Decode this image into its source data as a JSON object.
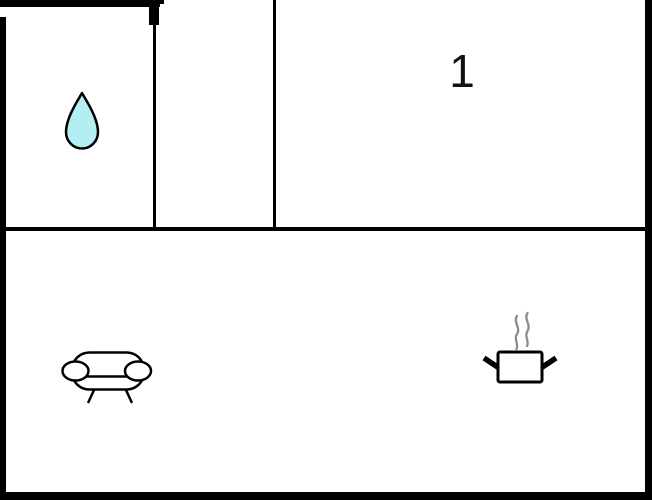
{
  "floorplan": {
    "room_label": "1",
    "icons": {
      "bathroom": "water-drop-icon",
      "living_room": "sofa-icon",
      "kitchen": "cooking-pot-steam-icon"
    },
    "colors": {
      "wall": "#000000",
      "background": "#ffffff",
      "water_drop_fill": "#b5eef2",
      "water_drop_outline": "#000000",
      "steam": "#8c8c8c",
      "label": "#111111"
    }
  }
}
